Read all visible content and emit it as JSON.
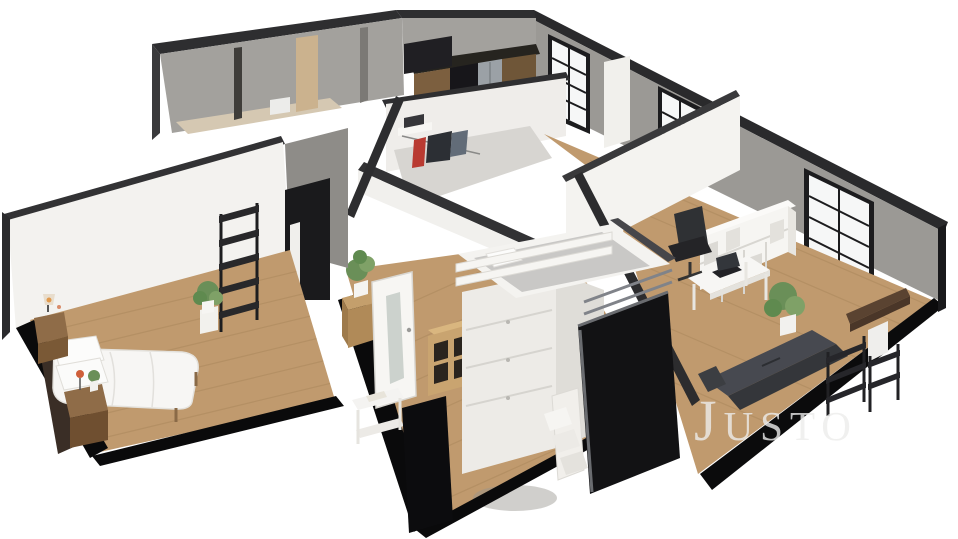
{
  "scene": {
    "kind": "3d-floorplan-dollhouse-render",
    "background": "#ffffff",
    "view": "isometric cutaway of an apartment, white walls, wood floors, black window frames"
  },
  "watermark": {
    "text": "Justo",
    "color": "#ededec"
  },
  "palette": {
    "background": "#ffffff",
    "wall_top_edge": "#2e2e30",
    "exterior_wall": "#9b9995",
    "exterior_wall_light": "#a3a19d",
    "interior_wall": "#f3f2ef",
    "interior_wall_shadow": "#8e8c88",
    "floor_wood": "#c09a6e",
    "floor_plank_line": "#a8855a",
    "closet_floor": "#d7d5d1",
    "slab_dark": "#0b0b0c",
    "window_frame": "#1c1c1e",
    "window_pane": "#f6f7f7",
    "furniture_white": "#f2f1ee",
    "furniture_dark": "#121214",
    "sofa": "#474950",
    "sofa_back": "#34363a",
    "wood_furniture": "#b08a58",
    "wood_furniture_top": "#c49f6c",
    "plant_green": "#6a8f58",
    "plant_green_light": "#7fa167",
    "accent_tan": "#cbb28e",
    "fridge_steel": "#9ba1a6",
    "bedding_white": "#f7f6f4",
    "mattress_gray": "#c9c8c6",
    "garment_red": "#b93a31",
    "garment_dark": "#2c2f34",
    "garment_blue": "#626c78",
    "lamp_glow": "#d9823f"
  },
  "rooms": {
    "bedroom_left": {
      "name": "bedroom-left",
      "furniture": [
        "double-bed-white-bedding",
        "pillows",
        "wood-nightstand-with-lamp",
        "wood-nightstand-with-plant-lamp",
        "black-ladder-shelf",
        "potted-plant-on-white-stand"
      ]
    },
    "bedroom_center": {
      "name": "bedroom-center",
      "furniture": [
        "white-loft-bed-with-drawers",
        "gray-mattress-white-pillow",
        "white-stairs",
        "dark-lower-panel",
        "wood-cube-shelf",
        "wood-sideboard-with-plant",
        "white-glass-door",
        "white-console-table",
        "black-wardrobe-panel"
      ]
    },
    "walk_in_closet": {
      "name": "walk-in-closet",
      "furniture": [
        "wall-shelf-with-folded-clothes",
        "clothes-rail-with-garments"
      ]
    },
    "kitchen": {
      "name": "kitchen",
      "furniture": [
        "dark-counter",
        "wood-cabinets",
        "stainless-fridge",
        "dark-upper-cabinet"
      ]
    },
    "living_office": {
      "name": "living-office",
      "furniture": [
        "white-desk",
        "black-office-chair",
        "laptop",
        "white-cube-shelving",
        "potted-plant",
        "dark-gray-sofa",
        "black-metal-shelves",
        "walnut-wall-desk",
        "tall-black-framed-windows"
      ]
    },
    "utility_wing": {
      "name": "bathroom-utility-wing",
      "furniture": [
        "gray-concrete-walls",
        "tan-accent-wall",
        "white-fixture"
      ]
    }
  }
}
